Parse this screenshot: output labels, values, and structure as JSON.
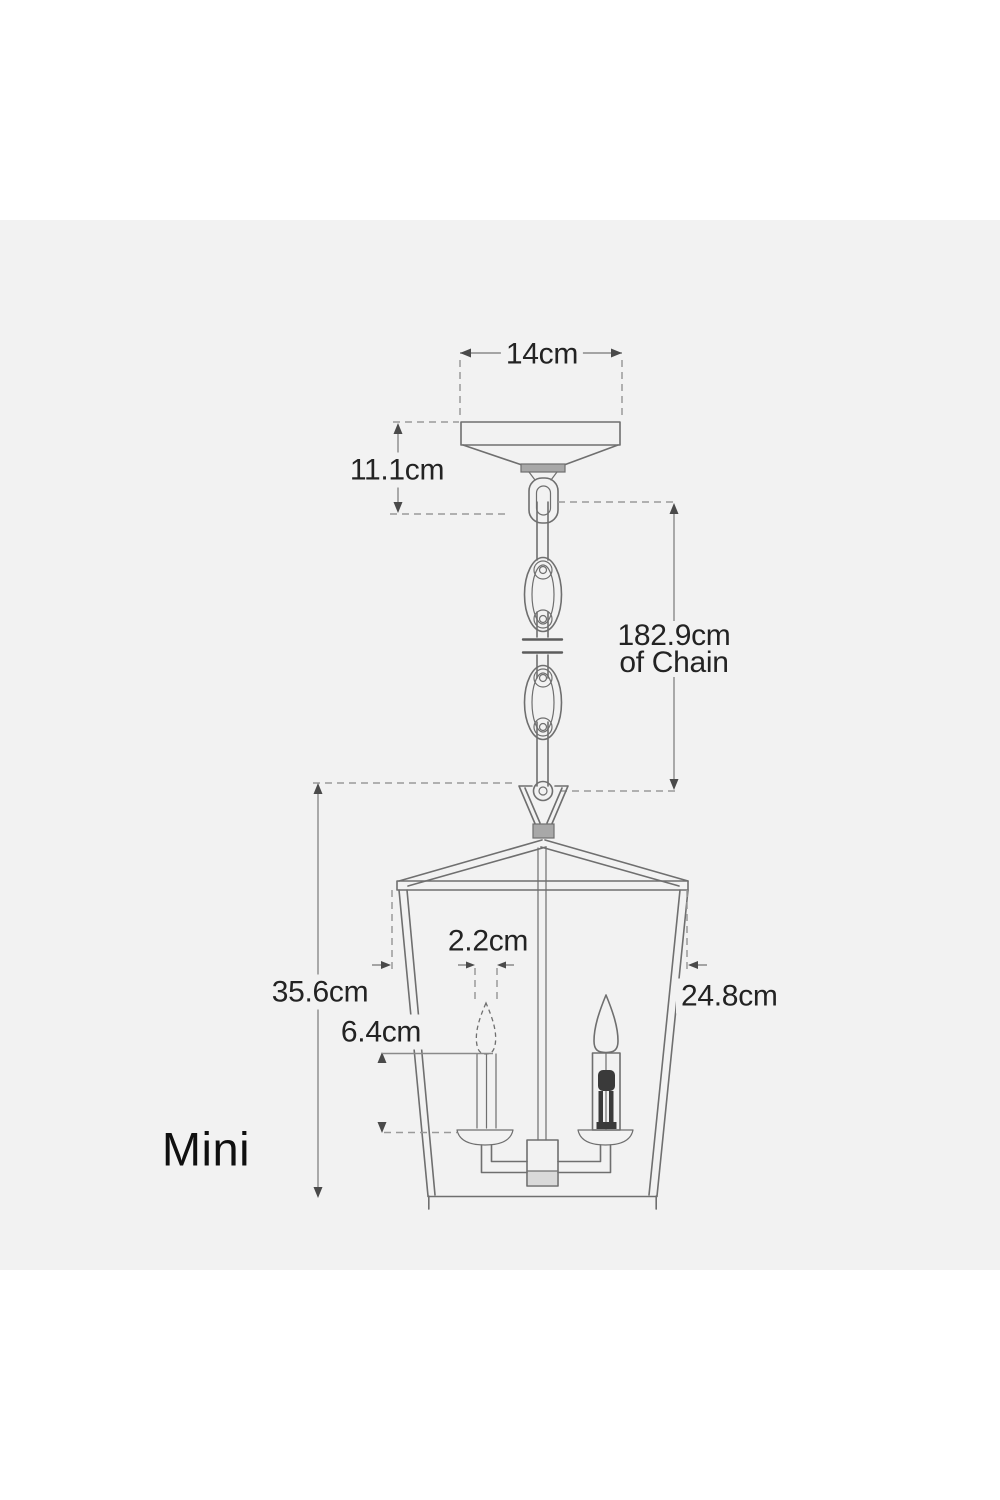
{
  "page": {
    "background": "#ffffff",
    "panel_background": "#f2f2f2"
  },
  "colors": {
    "line": "#6f6f6f",
    "line_dark": "#4a4a4a",
    "dashed": "#9a9a9a",
    "dim_line": "#8a8a8a",
    "text": "#232323",
    "socket": "#3a3a3a",
    "fill_light": "#d9d9d9",
    "fill_mid": "#a8a8a8"
  },
  "diagram": {
    "product_label": "Mini",
    "dimensions": {
      "canopy_width": "14cm",
      "canopy_height": "11.1cm",
      "chain_length": "182.9cm",
      "chain_length_unit": "of Chain",
      "lantern_height": "35.6cm",
      "candle_width": "2.2cm",
      "candle_height": "6.4cm",
      "lantern_width": "24.8cm"
    }
  }
}
